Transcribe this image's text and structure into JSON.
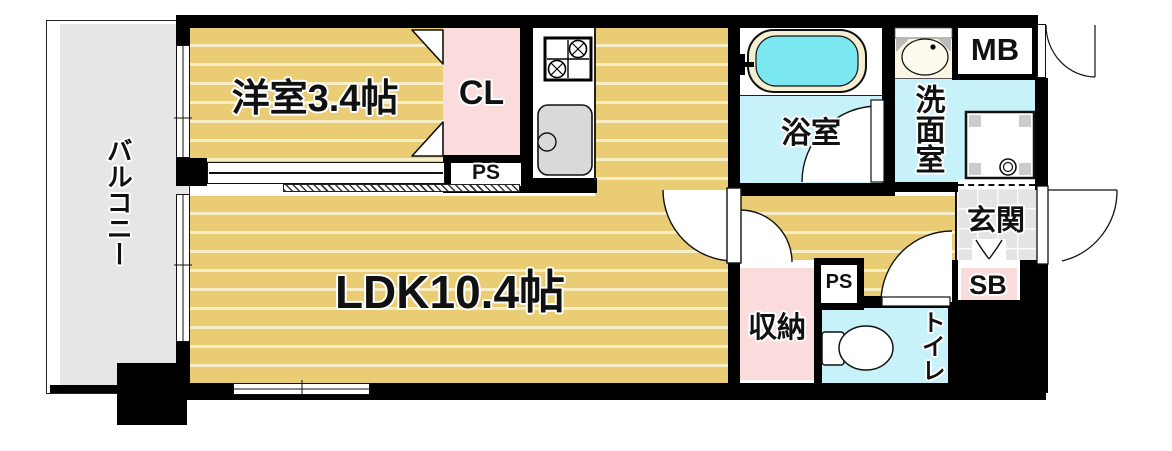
{
  "title": "apartment-floor-plan",
  "rooms": {
    "balcony": "バルコニー",
    "western_room": "洋室3.4帖",
    "closet": "CL",
    "pipe_space_upper": "PS",
    "ldk": "LDK10.4帖",
    "bathroom": "浴室",
    "washroom": "洗面室",
    "meter_box": "MB",
    "entrance": "玄関",
    "shoe_box": "SB",
    "storage": "収納",
    "pipe_space_lower": "PS",
    "toilet": "トイレ"
  },
  "colors": {
    "wood_floor": "#eacc74",
    "wood_floor_stripe": "#f8eec6",
    "pink_room": "#fadcdd",
    "wet_area_cyan": "#c8f2fa",
    "bathtub_water": "#7be7f0",
    "balcony_gray": "#e6e6e6",
    "entrance_tile": "#e4e4e4",
    "wall": "#000000"
  }
}
